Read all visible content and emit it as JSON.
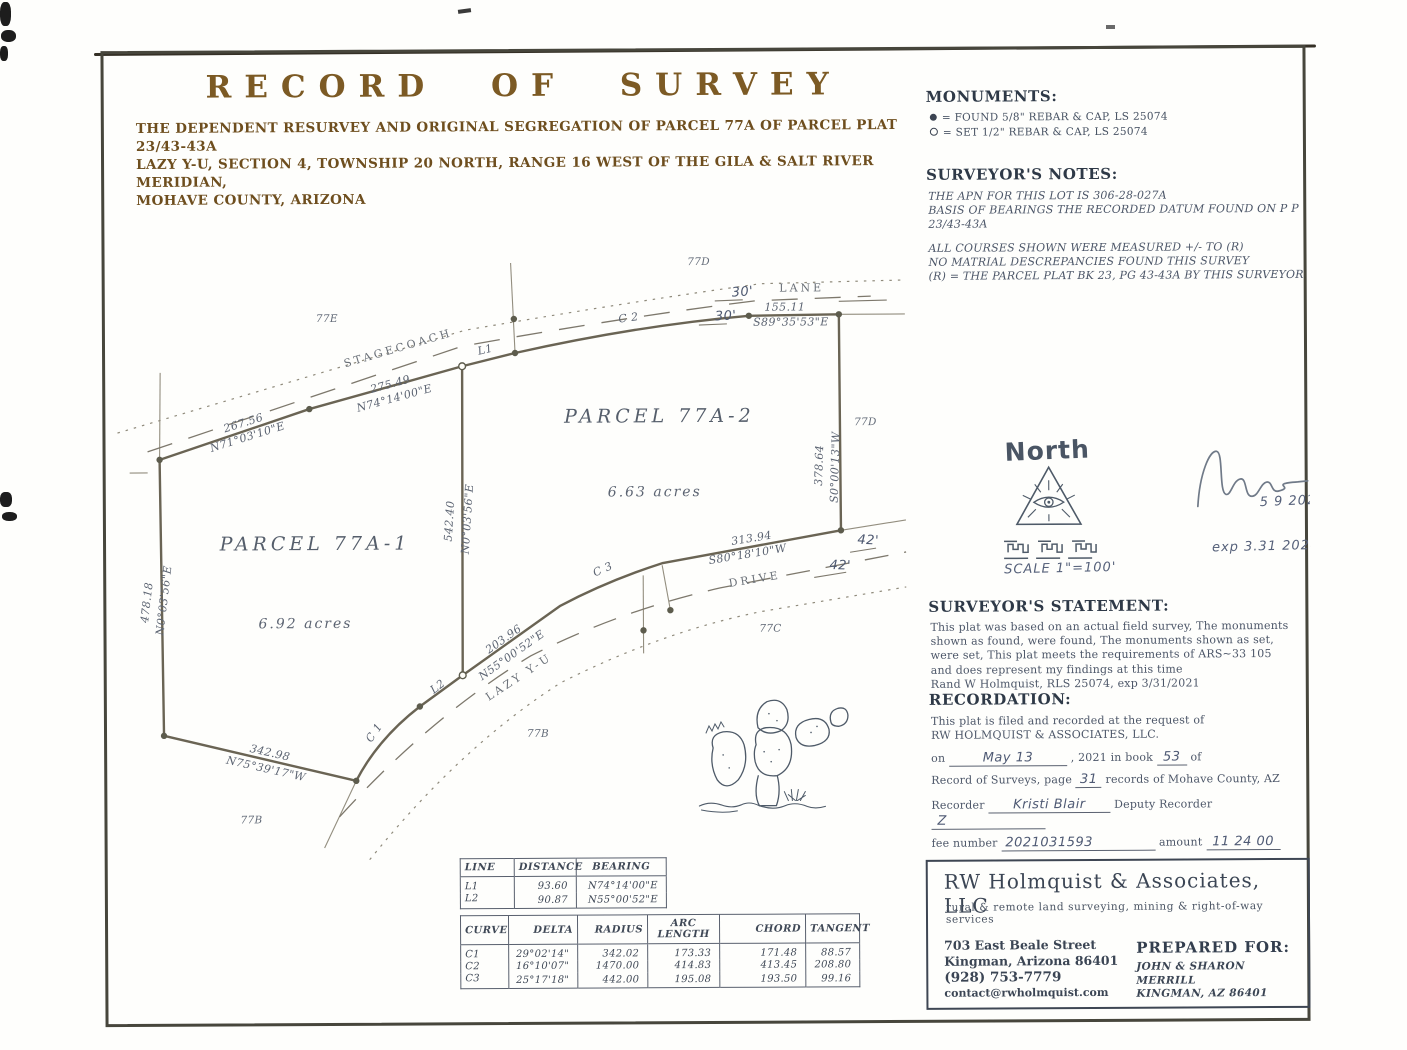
{
  "page": {
    "title": "RECORD OF SURVEY",
    "subtitle1": "THE DEPENDENT RESURVEY AND ORIGINAL SEGREGATION OF PARCEL 77A OF PARCEL PLAT 23/43-43A",
    "subtitle2": "LAZY Y-U, SECTION 4, TOWNSHIP 20 NORTH, RANGE 16 WEST OF THE GILA & SALT RIVER MERIDIAN,",
    "subtitle3": "MOHAVE COUNTY, ARIZONA"
  },
  "monuments": {
    "heading": "MONUMENTS:",
    "found_label": "= FOUND 5/8\" REBAR & CAP, LS 25074",
    "set_label": "= SET 1/2\" REBAR & CAP, LS 25074"
  },
  "notes": {
    "heading": "SURVEYOR'S NOTES:",
    "lines": [
      "THE APN FOR THIS LOT IS 306-28-027A",
      "BASIS OF BEARINGS  THE RECORDED DATUM FOUND ON P P  23/43-43A",
      "ALL COURSES SHOWN WERE MEASURED +/- TO (R)",
      "NO MATRIAL DESCREPANCIES FOUND THIS SURVEY",
      "(R) = THE PARCEL PLAT BK 23, PG 43-43A BY THIS SURVEYOR"
    ]
  },
  "north": {
    "label": "North",
    "scale": "SCALE 1\"=100'"
  },
  "signature": {
    "date": "5 9 2021",
    "exp": "exp  3.31 2024"
  },
  "statement": {
    "heading": "SURVEYOR'S STATEMENT:",
    "lines": [
      "This plat was based on an actual field survey, The monuments",
      "shown as found, were found, The monuments shown as set,",
      "were set, This plat meets the requirements of ARS~33 105",
      "and does represent my findings at this time",
      "Rand W Holmquist, RLS 25074, exp 3/31/2021"
    ]
  },
  "recordation": {
    "heading": "RECORDATION:",
    "line1": "This plat is filed and recorded at the request of",
    "line2": "RW HOLMQUIST & ASSOCIATES, LLC.",
    "on_label": "on",
    "date_handwritten": "May 13",
    "mid_label": ", 2021 in book",
    "book_handwritten": "53",
    "of_label": "of",
    "page_label": "Record of Surveys, page",
    "page_handwritten": "31",
    "records_label": "records of Mohave County, AZ",
    "recorder_label": "Recorder",
    "recorder_handwritten": "Kristi Blair",
    "deputy_label": "Deputy Recorder",
    "deputy_handwritten": "Z",
    "fee_label": "fee number",
    "fee_handwritten": "2021031593",
    "amount_label": "amount",
    "amount_handwritten": "11 24 00"
  },
  "firm": {
    "name": "RW Holmquist & Associates, LLC",
    "tagline": "rural & remote land surveying, mining & right-of-way services",
    "address1": "703 East Beale Street",
    "address2": "Kingman, Arizona 86401",
    "phone": "(928) 753-7779",
    "email": "contact@rwholmquist.com",
    "prepared_for": "PREPARED FOR:",
    "client1": "JOHN & SHARON MERRILL",
    "client2": "KINGMAN, AZ 86401"
  },
  "line_table": {
    "headers": [
      "LINE",
      "DISTANCE",
      "BEARING"
    ],
    "rows": [
      [
        "L1",
        "93.60",
        "N74°14'00\"E"
      ],
      [
        "L2",
        "90.87",
        "N55°00'52\"E"
      ]
    ]
  },
  "curve_table": {
    "headers": [
      "CURVE",
      "DELTA",
      "RADIUS",
      "ARC LENGTH",
      "CHORD",
      "TANGENT"
    ],
    "rows": [
      [
        "C1",
        "29°02'14\"",
        "342.02",
        "173.33",
        "171.48",
        "88.57"
      ],
      [
        "C2",
        "16°10'07\"",
        "1470.00",
        "414.83",
        "413.45",
        "208.80"
      ],
      [
        "C3",
        "25°17'18\"",
        "442.00",
        "195.08",
        "193.50",
        "99.16"
      ]
    ]
  },
  "map": {
    "parcel1": {
      "name": "PARCEL 77A-1",
      "area": "6.92 acres"
    },
    "parcel2": {
      "name": "PARCEL 77A-2",
      "area": "6.63 acres"
    },
    "roads": {
      "stagecoach": "STAGECOACH",
      "lane": "LANE",
      "lazy": "LAZY Y-U",
      "drive": "DRIVE"
    },
    "adjacent": {
      "e77": "77E",
      "d77_top": "77D",
      "d77_right": "77D",
      "c77": "77C",
      "b77_mid": "77B",
      "b77_left": "77B"
    },
    "dims": {
      "d1": {
        "dist": "267.56",
        "brg": "N71°03'10\"E"
      },
      "d2": {
        "dist": "275.49",
        "brg": "N74°14'00\"E"
      },
      "d3": {
        "dist": "155.11",
        "brg": "S89°35'53\"E"
      },
      "d4": {
        "dist": "378.64",
        "brg": "S0°00'13\"W"
      },
      "d5": {
        "dist": "313.94",
        "brg": "S80°18'10\"W"
      },
      "d6": {
        "dist": "203.96",
        "brg": "N55°00'52\"E"
      },
      "d7": {
        "dist": "342.98",
        "brg": "N75°39'17\"W"
      },
      "d8": {
        "dist": "478.18",
        "brg": "N0°03'56\"E"
      },
      "d9": {
        "dist": "542.40",
        "brg": "N0°03'56\"E"
      }
    },
    "refs": {
      "l1": "L1",
      "l2": "L2",
      "c1": "C 1",
      "c2": "C 2",
      "c3": "C 3"
    },
    "handwritten": {
      "w30a": "30'",
      "w30b": "30'",
      "w42a": "42'",
      "w42b": "42'"
    }
  }
}
